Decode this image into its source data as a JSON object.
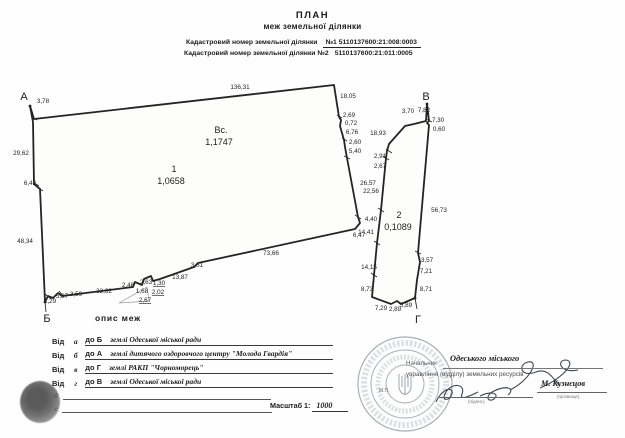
{
  "header": {
    "title": "ПЛАН",
    "subtitle": "меж земельної ділянки",
    "cad1_label": "Кадастровий номер земельної ділянки",
    "cad1_value": "№1  5110137600:21:008:0003",
    "cad2_label": "Кадастровий номер земельної ділянки №2",
    "cad2_value": "5110137600:21:011:0005"
  },
  "plan": {
    "points": [
      "А",
      "Б",
      "В",
      "Г"
    ],
    "parcel1": {
      "number": "1",
      "area": "1,0658"
    },
    "parcel2": {
      "number": "2",
      "area": "0,1089"
    },
    "total": {
      "label": "Вс.",
      "area": "1,1747"
    },
    "labels": [
      {
        "t": "3,78",
        "x": 43,
        "y": 103
      },
      {
        "t": "136,31",
        "x": 240,
        "y": 89
      },
      {
        "t": "18,05",
        "x": 348,
        "y": 98
      },
      {
        "t": "2,69",
        "x": 349,
        "y": 117
      },
      {
        "t": "0,72",
        "x": 351,
        "y": 125
      },
      {
        "t": "6,76",
        "x": 352,
        "y": 134
      },
      {
        "t": "2,60",
        "x": 355,
        "y": 144
      },
      {
        "t": "5,40",
        "x": 355,
        "y": 153
      },
      {
        "t": "26,57",
        "x": 368,
        "y": 185
      },
      {
        "t": "4,40",
        "x": 371,
        "y": 221
      },
      {
        "t": "6,47",
        "x": 359,
        "y": 237
      },
      {
        "t": "73,66",
        "x": 271,
        "y": 255
      },
      {
        "t": "3,61",
        "x": 197,
        "y": 267
      },
      {
        "t": "13,87",
        "x": 180,
        "y": 279
      },
      {
        "t": "2,46",
        "x": 128,
        "y": 287
      },
      {
        "t": "2,63",
        "x": 146,
        "y": 284
      },
      {
        "t": "1,30",
        "x": 159,
        "y": 285,
        "u": true
      },
      {
        "t": "1,68",
        "x": 142,
        "y": 293
      },
      {
        "t": "2,02",
        "x": 158,
        "y": 294,
        "u": true
      },
      {
        "t": "2,67",
        "x": 145,
        "y": 302,
        "u": true
      },
      {
        "t": "32,62",
        "x": 104,
        "y": 293
      },
      {
        "t": "3,59",
        "x": 76,
        "y": 296
      },
      {
        "t": "5,87",
        "x": 62,
        "y": 298
      },
      {
        "t": "1,29",
        "x": 50,
        "y": 303
      },
      {
        "t": "48,34",
        "x": 25,
        "y": 243
      },
      {
        "t": "6,42",
        "x": 30,
        "y": 185
      },
      {
        "t": "29,62",
        "x": 21,
        "y": 155
      },
      {
        "t": "3,70",
        "x": 408,
        "y": 113
      },
      {
        "t": "7,82",
        "x": 424,
        "y": 112
      },
      {
        "t": "7,30",
        "x": 438,
        "y": 122
      },
      {
        "t": "0,60",
        "x": 439,
        "y": 131
      },
      {
        "t": "18,93",
        "x": 378,
        "y": 135
      },
      {
        "t": "2,91",
        "x": 380,
        "y": 158
      },
      {
        "t": "2,67",
        "x": 380,
        "y": 168
      },
      {
        "t": "22,56",
        "x": 371,
        "y": 193
      },
      {
        "t": "56,73",
        "x": 439,
        "y": 212
      },
      {
        "t": "14,41",
        "x": 366,
        "y": 234
      },
      {
        "t": "14,15",
        "x": 369,
        "y": 269
      },
      {
        "t": "3,57",
        "x": 427,
        "y": 262
      },
      {
        "t": "7,21",
        "x": 426,
        "y": 273
      },
      {
        "t": "8,73",
        "x": 367,
        "y": 291
      },
      {
        "t": "8,71",
        "x": 426,
        "y": 291
      },
      {
        "t": "7,29",
        "x": 381,
        "y": 310
      },
      {
        "t": "2,89",
        "x": 395,
        "y": 311
      },
      {
        "t": "5,89",
        "x": 406,
        "y": 307
      }
    ]
  },
  "legend": {
    "title": "опис меж",
    "vid": "Від",
    "rows": [
      {
        "pt": "а",
        "to": "до Б",
        "text": "землі Одеської міської ради"
      },
      {
        "pt": "б",
        "to": "до А",
        "text": "землі дитячого оздоровчого центру \"Молода Гвардія\""
      },
      {
        "pt": "в",
        "to": "до Г",
        "text": "землі РАКП \"Чорноморець\""
      },
      {
        "pt": "г",
        "to": "до В",
        "text": "землі Одеської міської ради"
      }
    ],
    "empty_rows": [
      {
        "pt": "д"
      },
      {
        "pt": "е"
      }
    ]
  },
  "scale": {
    "label": "Масштаб 1:",
    "value": "1000"
  },
  "approval": {
    "position_prefix": "Начальник",
    "org_line1": "Одеського міського",
    "org_line2": "управління (відділу) земельних ресурсів",
    "name": "М. Кузнєцов",
    "sig_caption": "(підпис)",
    "name_caption": "(прізвище)",
    "seal_mp": "М.П."
  }
}
